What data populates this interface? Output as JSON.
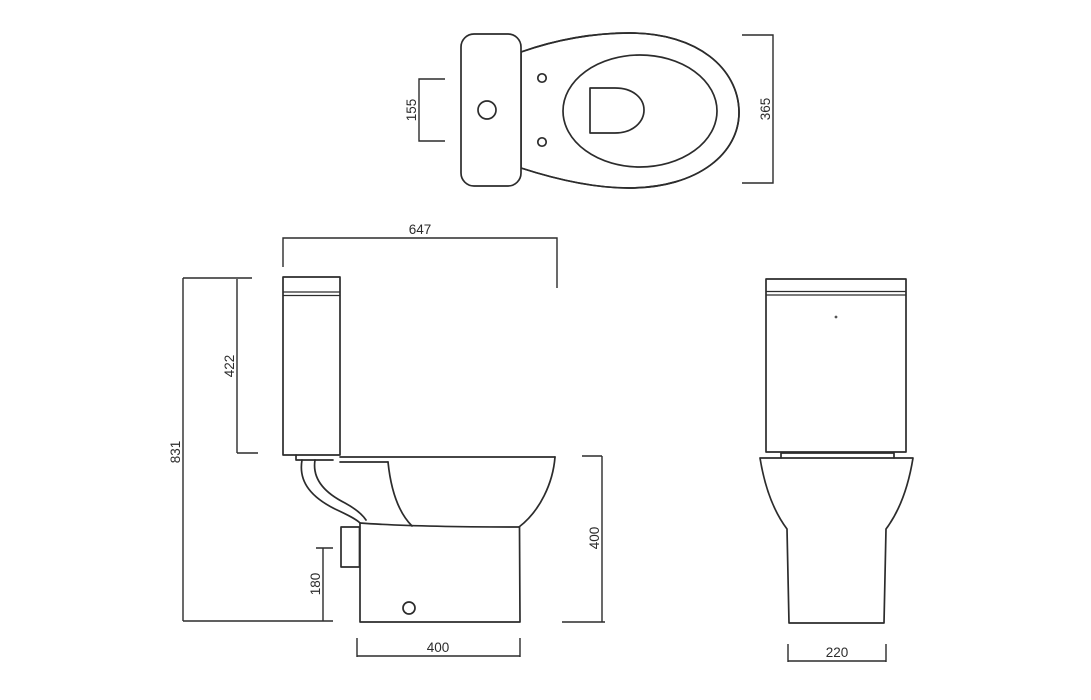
{
  "drawing": {
    "background_color": "#ffffff",
    "line_color": "#2c2c2c",
    "views": {
      "top": {
        "dims": {
          "cistern_depth": "155",
          "seat_width": "365"
        }
      },
      "side": {
        "dims": {
          "overall_depth": "647",
          "cistern_height": "422",
          "overall_height": "831",
          "outlet_height": "180",
          "base_depth": "400",
          "pan_height": "400"
        }
      },
      "front": {
        "dims": {
          "base_width": "220"
        }
      }
    }
  }
}
